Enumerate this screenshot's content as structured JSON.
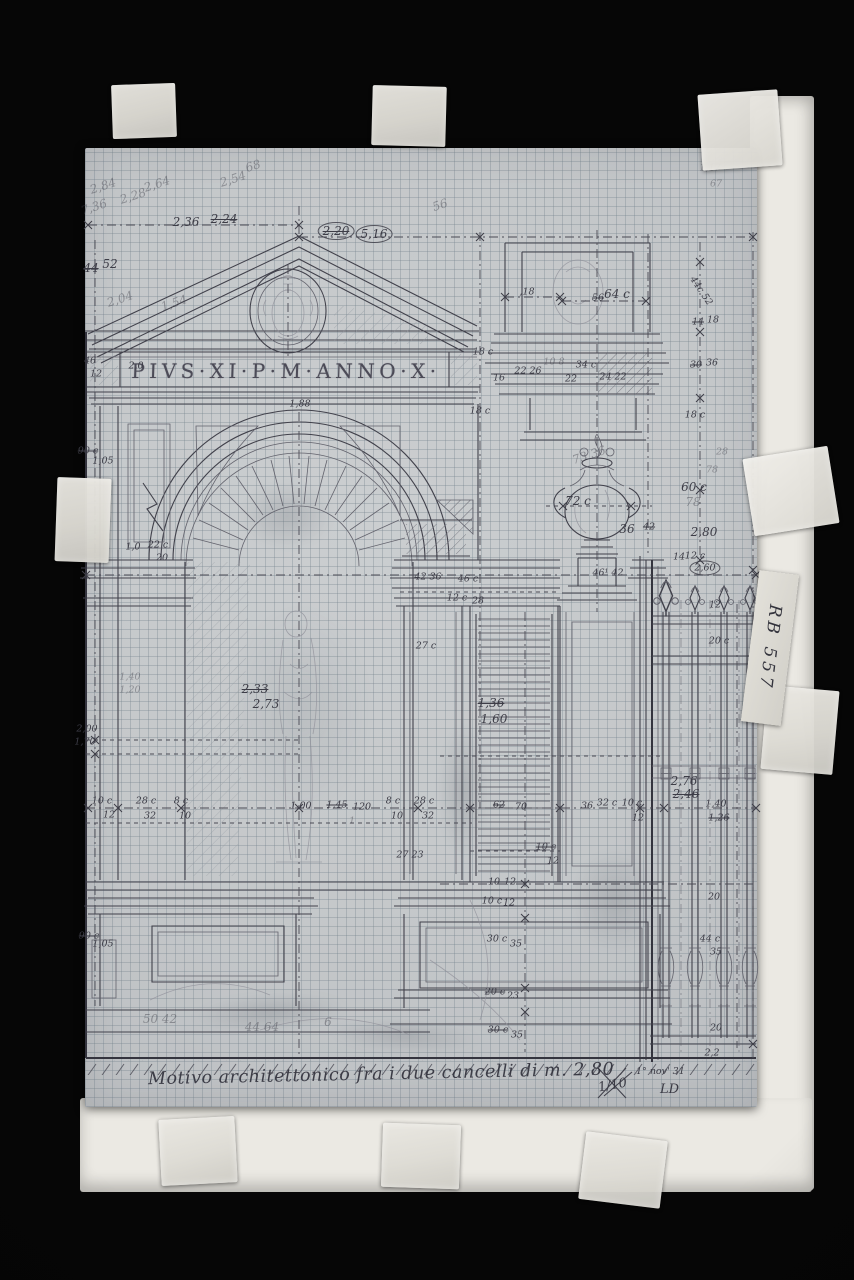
{
  "photo": {
    "background_color": "#060606",
    "mount_color": "#ebe9e3",
    "paper_color": "#c6c9cb",
    "grid_color": "#99a6ae",
    "pencil_dark": "#41414b",
    "pencil_faint": "#90909a"
  },
  "labels": {
    "inscription": "PIVS·XI·P·M·ANNO·X·",
    "caption": "Motivo architettonico fra i due cancelli di m. 2,80",
    "archive_label": "RB 557",
    "scale_note": "1/10",
    "date_note": "1° nov' 31",
    "monogram": "LD"
  },
  "annotations": [
    {
      "x": 186,
      "y": 222,
      "t": "2,36"
    },
    {
      "x": 224,
      "y": 219,
      "t": "2,24",
      "c": "s"
    },
    {
      "x": 336,
      "y": 231,
      "t": "2,20",
      "c": "s ci"
    },
    {
      "x": 374,
      "y": 234,
      "t": "5,16",
      "c": "ci"
    },
    {
      "x": 91,
      "y": 268,
      "t": "44",
      "c": "s"
    },
    {
      "x": 110,
      "y": 264,
      "t": "52"
    },
    {
      "x": 103,
      "y": 186,
      "t": "2,84",
      "c": "f r"
    },
    {
      "x": 94,
      "y": 207,
      "t": "7,36",
      "c": "f r"
    },
    {
      "x": 133,
      "y": 196,
      "t": "2,28",
      "c": "f r"
    },
    {
      "x": 157,
      "y": 184,
      "t": "2,64",
      "c": "f r"
    },
    {
      "x": 233,
      "y": 179,
      "t": "2,54",
      "c": "f r"
    },
    {
      "x": 253,
      "y": 166,
      "t": "68",
      "c": "f r"
    },
    {
      "x": 120,
      "y": 299,
      "t": "2,04",
      "c": "f r"
    },
    {
      "x": 174,
      "y": 303,
      "t": "1,54",
      "c": "f r"
    },
    {
      "x": 440,
      "y": 205,
      "t": "56",
      "c": "f r"
    },
    {
      "x": 710,
      "y": 168,
      "t": "1,17",
      "c": "f t"
    },
    {
      "x": 716,
      "y": 184,
      "t": "67",
      "c": "f t"
    },
    {
      "x": 90,
      "y": 361,
      "t": "46",
      "c": "t"
    },
    {
      "x": 96,
      "y": 374,
      "t": "12",
      "c": "t"
    },
    {
      "x": 136,
      "y": 366,
      "t": "2,0",
      "c": "t"
    },
    {
      "x": 483,
      "y": 352,
      "t": "18 c",
      "c": "t"
    },
    {
      "x": 499,
      "y": 378,
      "t": "16",
      "c": "t"
    },
    {
      "x": 528,
      "y": 371,
      "t": "22 26",
      "c": "t"
    },
    {
      "x": 554,
      "y": 362,
      "t": "10 8",
      "c": "t f"
    },
    {
      "x": 586,
      "y": 365,
      "t": "34 c",
      "c": "t"
    },
    {
      "x": 571,
      "y": 379,
      "t": "22",
      "c": "t"
    },
    {
      "x": 613,
      "y": 377,
      "t": "24 22",
      "c": "t"
    },
    {
      "x": 527,
      "y": 292,
      "t": ",18",
      "c": "t"
    },
    {
      "x": 598,
      "y": 298,
      "t": "56",
      "c": "s t"
    },
    {
      "x": 617,
      "y": 294,
      "t": "64 c"
    },
    {
      "x": 701,
      "y": 291,
      "t": "44c 52",
      "c": "t r2"
    },
    {
      "x": 698,
      "y": 322,
      "t": "14",
      "c": "s t"
    },
    {
      "x": 713,
      "y": 320,
      "t": "18",
      "c": "t"
    },
    {
      "x": 300,
      "y": 404,
      "t": "1,88",
      "c": "t"
    },
    {
      "x": 88,
      "y": 451,
      "t": "90 c",
      "c": "s t"
    },
    {
      "x": 103,
      "y": 461,
      "t": "1,05",
      "c": "t"
    },
    {
      "x": 480,
      "y": 411,
      "t": "18 c",
      "c": "t"
    },
    {
      "x": 696,
      "y": 365,
      "t": "30",
      "c": "s t"
    },
    {
      "x": 712,
      "y": 363,
      "t": "36",
      "c": "t"
    },
    {
      "x": 695,
      "y": 415,
      "t": "18 c",
      "c": "t"
    },
    {
      "x": 722,
      "y": 452,
      "t": "28",
      "c": "f t"
    },
    {
      "x": 712,
      "y": 470,
      "t": "78",
      "c": "f t"
    },
    {
      "x": 694,
      "y": 487,
      "t": "60 c"
    },
    {
      "x": 693,
      "y": 502,
      "t": "78",
      "c": "f"
    },
    {
      "x": 578,
      "y": 501,
      "t": "72 c"
    },
    {
      "x": 627,
      "y": 529,
      "t": "36"
    },
    {
      "x": 649,
      "y": 527,
      "t": "42",
      "c": "s t"
    },
    {
      "x": 704,
      "y": 532,
      "t": "2,80"
    },
    {
      "x": 679,
      "y": 557,
      "t": "14",
      "c": "t"
    },
    {
      "x": 695,
      "y": 556,
      "t": "12 c",
      "c": "t"
    },
    {
      "x": 705,
      "y": 568,
      "t": "2,60",
      "c": "ci t"
    },
    {
      "x": 589,
      "y": 455,
      "t": "73 36",
      "c": "f r"
    },
    {
      "x": 133,
      "y": 547,
      "t": "1,0",
      "c": "t"
    },
    {
      "x": 158,
      "y": 545,
      "t": "22 c",
      "c": "t"
    },
    {
      "x": 162,
      "y": 558,
      "t": "20",
      "c": "t"
    },
    {
      "x": 428,
      "y": 577,
      "t": "42 36",
      "c": "t"
    },
    {
      "x": 468,
      "y": 579,
      "t": "46 c",
      "c": "t"
    },
    {
      "x": 608,
      "y": 573,
      "t": "46¹ 42",
      "c": "t"
    },
    {
      "x": 457,
      "y": 598,
      "t": "12 c",
      "c": "t"
    },
    {
      "x": 478,
      "y": 601,
      "t": "28",
      "c": "t"
    },
    {
      "x": 426,
      "y": 646,
      "t": "27 c",
      "c": "t"
    },
    {
      "x": 255,
      "y": 689,
      "t": "2,33",
      "c": "s"
    },
    {
      "x": 266,
      "y": 704,
      "t": "2,73"
    },
    {
      "x": 130,
      "y": 677,
      "t": "1,40",
      "c": "f t"
    },
    {
      "x": 130,
      "y": 690,
      "t": "1,20",
      "c": "f t"
    },
    {
      "x": 491,
      "y": 703,
      "t": "1,36",
      "c": "s"
    },
    {
      "x": 494,
      "y": 719,
      "t": "1,60"
    },
    {
      "x": 87,
      "y": 729,
      "t": "2,00",
      "c": "t"
    },
    {
      "x": 85,
      "y": 742,
      "t": "1,70",
      "c": "t"
    },
    {
      "x": 102,
      "y": 801,
      "t": "10 c",
      "c": "t"
    },
    {
      "x": 109,
      "y": 815,
      "t": "12",
      "c": "t"
    },
    {
      "x": 146,
      "y": 801,
      "t": "28 c",
      "c": "t"
    },
    {
      "x": 150,
      "y": 816,
      "t": "32",
      "c": "t"
    },
    {
      "x": 181,
      "y": 801,
      "t": "8 c",
      "c": "t"
    },
    {
      "x": 185,
      "y": 816,
      "t": "10",
      "c": "t"
    },
    {
      "x": 301,
      "y": 806,
      "t": "1,00",
      "c": "t"
    },
    {
      "x": 337,
      "y": 805,
      "t": "1,45",
      "c": "s t"
    },
    {
      "x": 362,
      "y": 807,
      "t": "120",
      "c": "t"
    },
    {
      "x": 352,
      "y": 821,
      "t": "1",
      "c": "t f"
    },
    {
      "x": 393,
      "y": 801,
      "t": "8 c",
      "c": "t"
    },
    {
      "x": 397,
      "y": 816,
      "t": "10",
      "c": "t"
    },
    {
      "x": 424,
      "y": 801,
      "t": "28 c",
      "c": "t"
    },
    {
      "x": 428,
      "y": 816,
      "t": "32",
      "c": "t"
    },
    {
      "x": 499,
      "y": 805,
      "t": "62",
      "c": "s t"
    },
    {
      "x": 521,
      "y": 807,
      "t": "70",
      "c": "t"
    },
    {
      "x": 587,
      "y": 806,
      "t": "36",
      "c": "t"
    },
    {
      "x": 607,
      "y": 803,
      "t": "32 c",
      "c": "t"
    },
    {
      "x": 632,
      "y": 803,
      "t": "10 c",
      "c": "t"
    },
    {
      "x": 638,
      "y": 818,
      "t": "12",
      "c": "t"
    },
    {
      "x": 684,
      "y": 781,
      "t": "2,76"
    },
    {
      "x": 686,
      "y": 794,
      "t": "2,46",
      "c": "s"
    },
    {
      "x": 716,
      "y": 804,
      "t": "1,40",
      "c": "t"
    },
    {
      "x": 719,
      "y": 818,
      "t": "1,26",
      "c": "s t"
    },
    {
      "x": 410,
      "y": 855,
      "t": "27 23",
      "c": "t"
    },
    {
      "x": 546,
      "y": 847,
      "t": "10 c",
      "c": "s t"
    },
    {
      "x": 553,
      "y": 861,
      "t": "12",
      "c": "t"
    },
    {
      "x": 494,
      "y": 882,
      "t": "10",
      "c": "s t"
    },
    {
      "x": 510,
      "y": 882,
      "t": "12",
      "c": "t"
    },
    {
      "x": 492,
      "y": 901,
      "t": "10 c",
      "c": "t"
    },
    {
      "x": 509,
      "y": 903,
      "t": "12",
      "c": "t"
    },
    {
      "x": 497,
      "y": 939,
      "t": "30 c",
      "c": "t"
    },
    {
      "x": 516,
      "y": 944,
      "t": "35",
      "c": "t"
    },
    {
      "x": 495,
      "y": 992,
      "t": "20 c",
      "c": "s t"
    },
    {
      "x": 513,
      "y": 996,
      "t": "23",
      "c": "t"
    },
    {
      "x": 498,
      "y": 1030,
      "t": "30 c",
      "c": "s t"
    },
    {
      "x": 517,
      "y": 1035,
      "t": "35",
      "c": "t"
    },
    {
      "x": 89,
      "y": 936,
      "t": "90 c",
      "c": "s t"
    },
    {
      "x": 103,
      "y": 944,
      "t": "1,05",
      "c": "t"
    },
    {
      "x": 160,
      "y": 1019,
      "t": "50 42",
      "c": "f"
    },
    {
      "x": 262,
      "y": 1027,
      "t": "44 64",
      "c": "f"
    },
    {
      "x": 328,
      "y": 1022,
      "t": "6",
      "c": "f"
    },
    {
      "x": 715,
      "y": 605,
      "t": "12",
      "c": "t"
    },
    {
      "x": 719,
      "y": 641,
      "t": "20 c",
      "c": "t"
    },
    {
      "x": 714,
      "y": 897,
      "t": "20",
      "c": "t"
    },
    {
      "x": 710,
      "y": 939,
      "t": "44 c",
      "c": "t"
    },
    {
      "x": 716,
      "y": 952,
      "t": "35",
      "c": "t"
    },
    {
      "x": 716,
      "y": 1028,
      "t": "20",
      "c": "t"
    },
    {
      "x": 712,
      "y": 1053,
      "t": "2,2",
      "c": "t"
    }
  ]
}
